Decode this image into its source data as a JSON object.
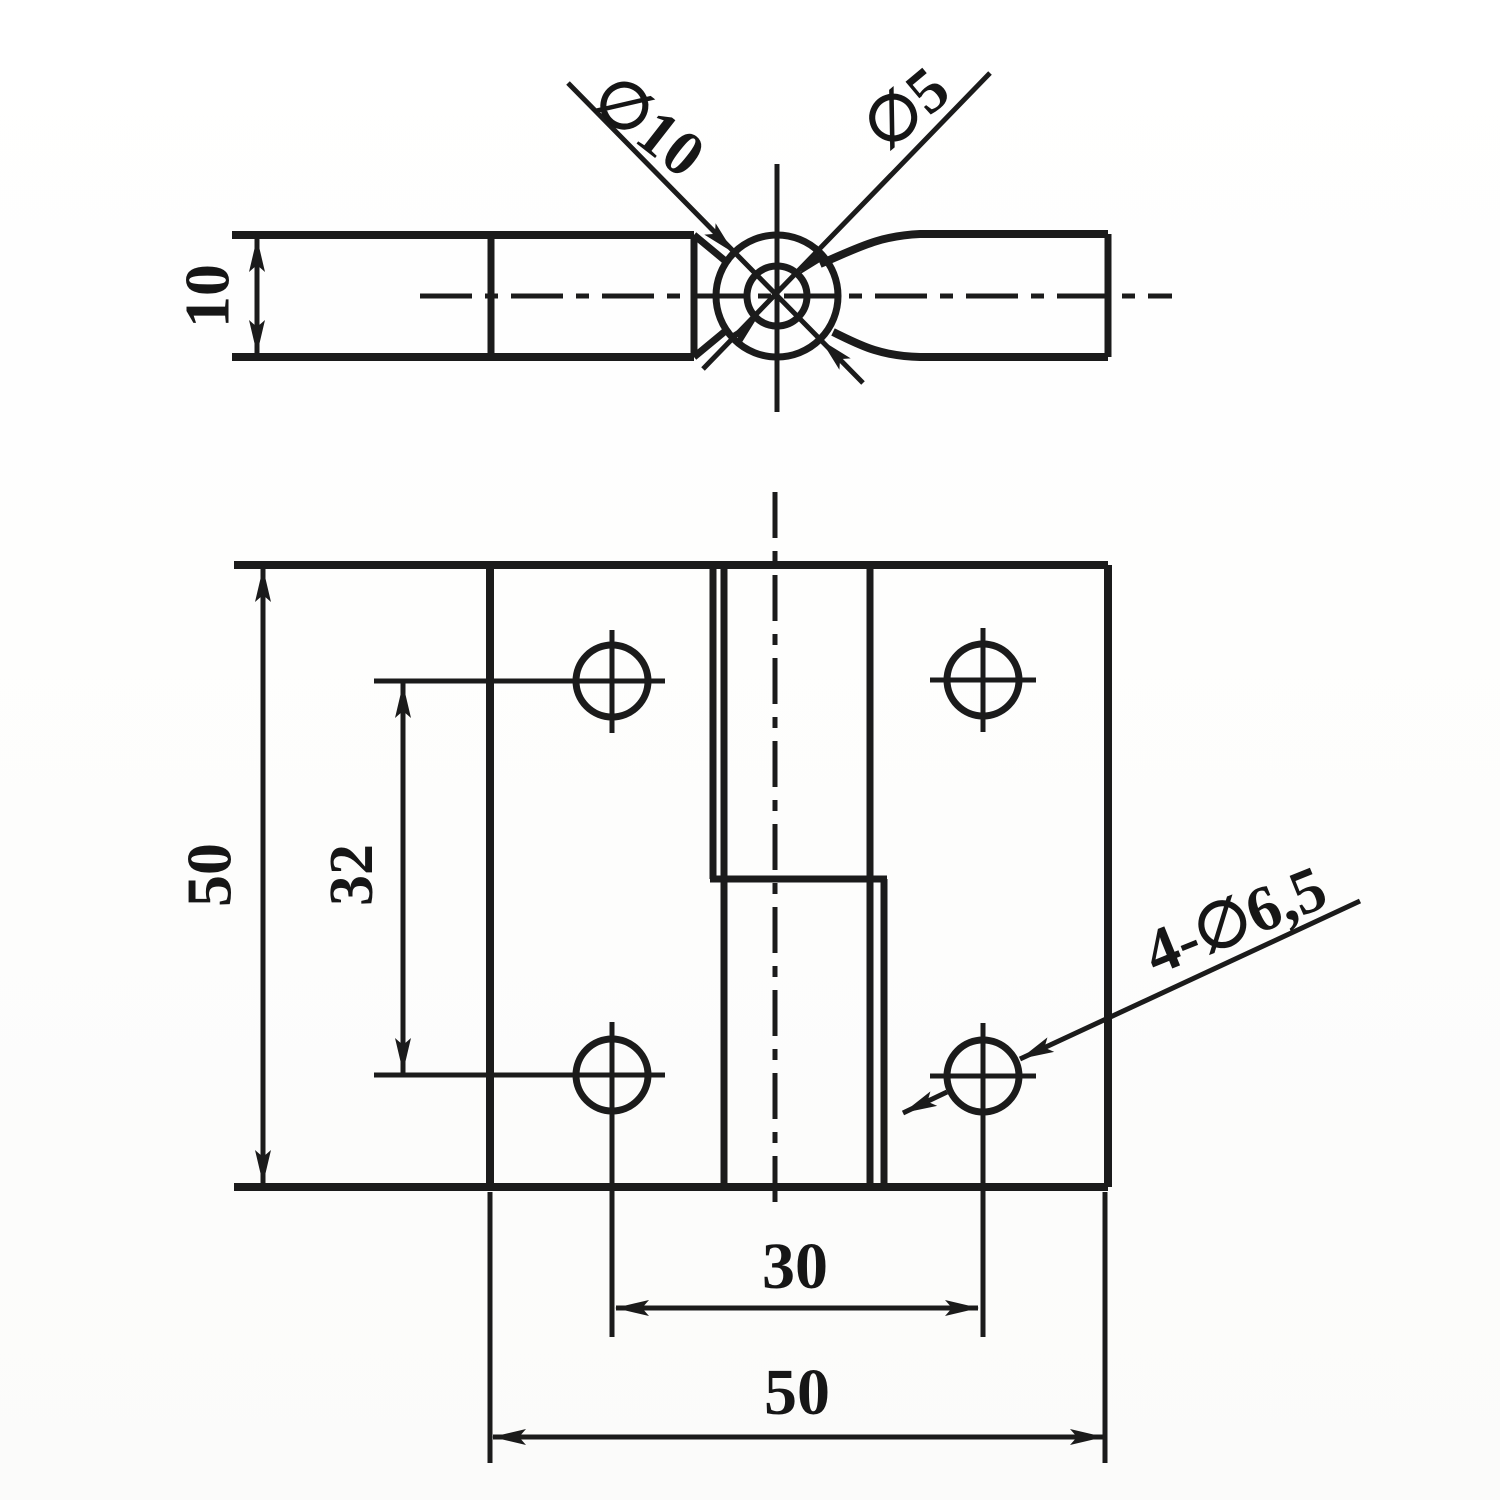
{
  "drawing": {
    "paper_color": "#ffffff",
    "ink_color": "#1b1b1b",
    "side_view": {
      "thickness_label": "10",
      "knuckle_diameter_label": "∅10",
      "pin_hole_diameter_label": "∅5"
    },
    "front_view": {
      "plate_height_label": "50",
      "hole_spacing_vertical_label": "32",
      "hole_spacing_horizontal_label": "30",
      "plate_width_label": "50",
      "hole_callout_label": "4-∅6,5"
    }
  }
}
